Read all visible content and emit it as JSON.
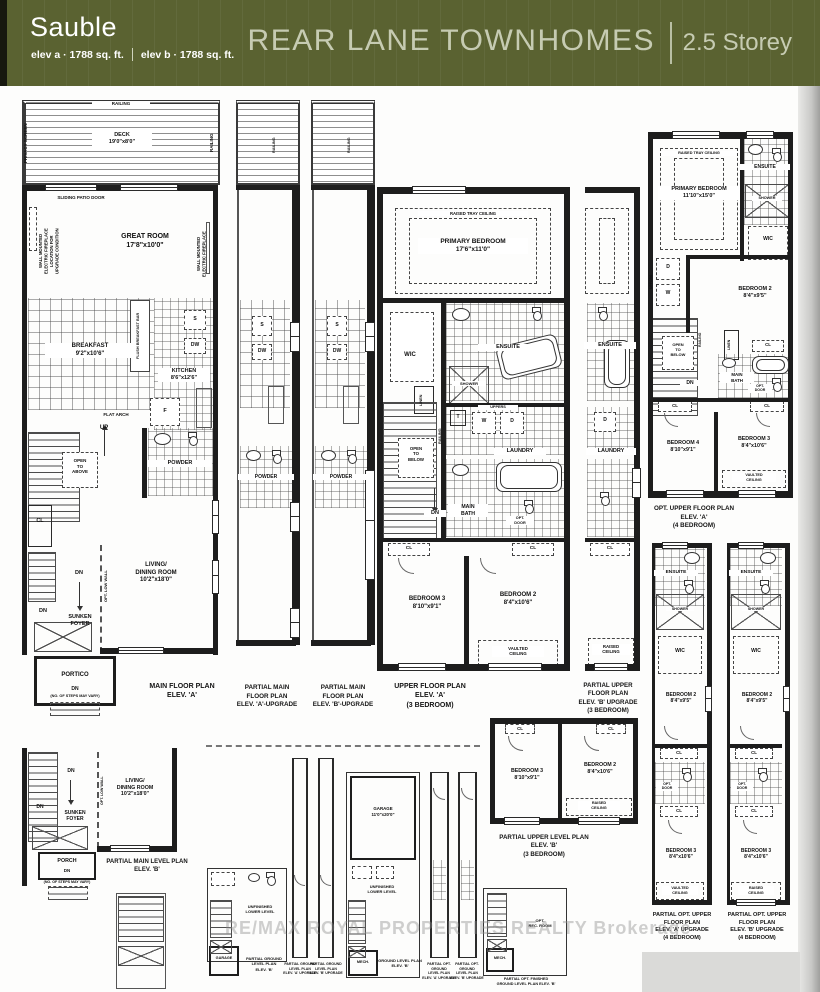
{
  "header": {
    "model": "Sauble",
    "elev_a": "elev a · 1788 sq. ft.",
    "elev_b": "elev b · 1788 sq. ft.",
    "series_title": "REAR LANE TOWNHOMES",
    "storey": "2.5 Storey"
  },
  "watermark": "RE/MAX ROYAL PROPERTIES REALTY Brokerage",
  "main_a": {
    "railing": "RAILING",
    "privacy": "PRIVACY SCREEN",
    "railing_r": "RAILING",
    "deck": "DECK\n19'0\"x8'0\"",
    "patio_door": "SLIDING PATIO DOOR",
    "fp_note": "WALL MOUNTED\nELECTRIC FIREPLACE\nLOCATION FOR\nUPGRADE CONDITION",
    "great": "GREAT ROOM\n17'8\"x10'0\"",
    "fp_wall": "WALL MOUNTED\nELECTRIC FIREPLACE",
    "breakfast": "BREAKFAST\n9'2\"x10'6\"",
    "flush_bar": "FLUSH BREAKFAST BAR",
    "kitchen": "KITCHEN\n8'6\"x12'6\"",
    "s": "S",
    "dw": "DW",
    "f": "F",
    "flat_arch": "FLAT ARCH",
    "up": "UP",
    "open_above": "OPEN\nTO\nABOVE",
    "cl": "CL",
    "powder": "POWDER",
    "low_wall": "OPT. LOW WALL",
    "dn": "DN",
    "living": "LIVING/\nDINING ROOM\n10'2\"x18'0\"",
    "sunken": "SUNKEN\nFOYER",
    "portico": "PORTICO",
    "steps": "(NO. OF STEPS MAY VARY)",
    "caption": "MAIN FLOOR PLAN\nELEV. 'A'"
  },
  "strip_a": {
    "railing": "RAILING",
    "s": "S",
    "dw": "DW",
    "powder": "POWDER",
    "caption": "PARTIAL MAIN\nFLOOR PLAN\nELEV. 'A'-UPGRADE"
  },
  "strip_b": {
    "railing": "RAILING",
    "s": "S",
    "dw": "DW",
    "powder": "POWDER",
    "caption": "PARTIAL MAIN\nFLOOR PLAN\nELEV. 'B'-UPGRADE"
  },
  "upper_a": {
    "tray": "RAISED TRAY CEILING",
    "primary": "PRIMARY BEDROOM\n17'6\"x11'0\"",
    "wic": "WIC",
    "linen": "LINEN",
    "ensuite": "ENSUITE",
    "shower": "SHOWER",
    "uppers": "UPPERS",
    "t": "T",
    "w": "W",
    "d": "D",
    "laundry": "LAUNDRY",
    "railing": "RAILING",
    "open_below": "OPEN\nTO\nBELOW",
    "dn": "DN",
    "main_bath": "MAIN\nBATH",
    "opt_door": "OPT.\nDOOR",
    "cl": "CL",
    "bed3": "BEDROOM 3\n8'10\"x9'1\"",
    "bed2": "BEDROOM 2\n8'4\"x10'6\"",
    "vaulted": "VAULTED\nCEILING",
    "caption": "UPPER FLOOR PLAN\nELEV. 'A'\n(3 BEDROOM)"
  },
  "upper_b": {
    "ensuite": "ENSUITE",
    "d": "D",
    "laundry": "LAUNDRY",
    "cl": "CL",
    "raised": "RAISED\nCEILING",
    "caption": "PARTIAL UPPER\nFLOOR PLAN\nELEV. 'B' UPGRADE\n(3 BEDROOM)"
  },
  "opt4a": {
    "tray": "RAISED TRAY CEILING",
    "primary": "PRIMARY BEDROOM\n11'10\"x15'0\"",
    "ensuite": "ENSUITE",
    "shower": "SHOWER",
    "wic": "WIC",
    "uppers": "UPPERS",
    "d": "D",
    "w": "W",
    "bed2": "BEDROOM 2\n8'4\"x9'5\"",
    "open_below": "OPEN\nTO\nBELOW",
    "railing": "RAILING",
    "dn": "DN",
    "linen": "LINEN",
    "cl": "CL",
    "main_bath": "MAIN\nBATH",
    "opt_door": "OPT.\nDOOR",
    "bed4": "BEDROOM 4\n8'10\"x9'1\"",
    "bed3": "BEDROOM 3\n8'4\"x10'6\"",
    "vaulted": "VAULTED\nCEILING",
    "caption": "OPT. UPPER FLOOR PLAN\nELEV. 'A'\n(4 BEDROOM)"
  },
  "strip4a": {
    "ensuite": "ENSUITE",
    "shower": "SHOWER",
    "wic": "WIC",
    "bed2": "BEDROOM 2\n8'4\"x9'5\"",
    "cl": "CL",
    "opt_door": "OPT.\nDOOR",
    "bed3": "BEDROOM 3\n8'4\"x10'6\"",
    "ceiling": "VAULTED\nCEILING",
    "caption": "PARTIAL OPT. UPPER\nFLOOR PLAN\nELEV. 'A' UPGRADE\n(4 BEDROOM)"
  },
  "strip4b": {
    "ensuite": "ENSUITE",
    "shower": "SHOWER",
    "wic": "WIC",
    "bed2": "BEDROOM 2\n8'4\"x9'5\"",
    "cl": "CL",
    "opt_door": "OPT.\nDOOR",
    "bed3": "BEDROOM 3\n8'4\"x10'6\"",
    "ceiling": "RAISED\nCEILING",
    "caption": "PARTIAL OPT. UPPER\nFLOOR PLAN\nELEV. 'B' UPGRADE\n(4 BEDROOM)"
  },
  "upperlvl_b": {
    "cl": "CL",
    "bed3": "BEDROOM 3\n8'10\"x9'1\"",
    "bed2": "BEDROOM 2\n8'4\"x10'6\"",
    "raised": "RAISED\nCEILING",
    "caption": "PARTIAL UPPER LEVEL PLAN\nELEV. 'B'\n(3 BEDROOM)"
  },
  "main_b": {
    "dn": "DN",
    "sunken": "SUNKEN\nFOYER",
    "low_wall": "OPT. LOW WALL",
    "living": "LIVING/\nDINING ROOM\n10'2\"x18'0\"",
    "porch": "PORCH",
    "steps": "(NO. OF STEPS MAY VARY)",
    "caption": "PARTIAL MAIN LEVEL PLAN\nELEV. 'B'"
  },
  "ground1": {
    "unfinished": "UNFINISHED\nLOWER LEVEL",
    "garage": "GARAGE",
    "caption": "PARTIAL GROUND LEVEL PLAN\nELEV. 'B'"
  },
  "gstrip_a": {
    "caption": "PARTIAL GROUND\nLEVEL PLAN\nELEV. 'A' UPGRADE"
  },
  "gstrip_b": {
    "caption": "PARTIAL GROUND\nLEVEL PLAN\nELEV. 'B' UPGRADE"
  },
  "ground2": {
    "garage": "GARAGE\n11'0\"x20'0\"",
    "unfinished": "UNFINISHED\nLOWER LEVEL",
    "mech": "MECH.",
    "caption": "GROUND LEVEL PLAN\nELEV. 'B'"
  },
  "ogstrip_a": {
    "caption": "PARTIAL OPT. GROUND\nLEVEL PLAN\nELEV. 'A' UPGRADE"
  },
  "ogstrip_b": {
    "caption": "PARTIAL OPT. GROUND\nLEVEL PLAN\nELEV. 'B' UPGRADE"
  },
  "ground3": {
    "rec": "OPT.\nREC. ROOM",
    "mech": "MECH.",
    "caption": "PARTIAL OPT. FINISHED\nGROUND LEVEL PLAN ELEV. 'B'"
  }
}
